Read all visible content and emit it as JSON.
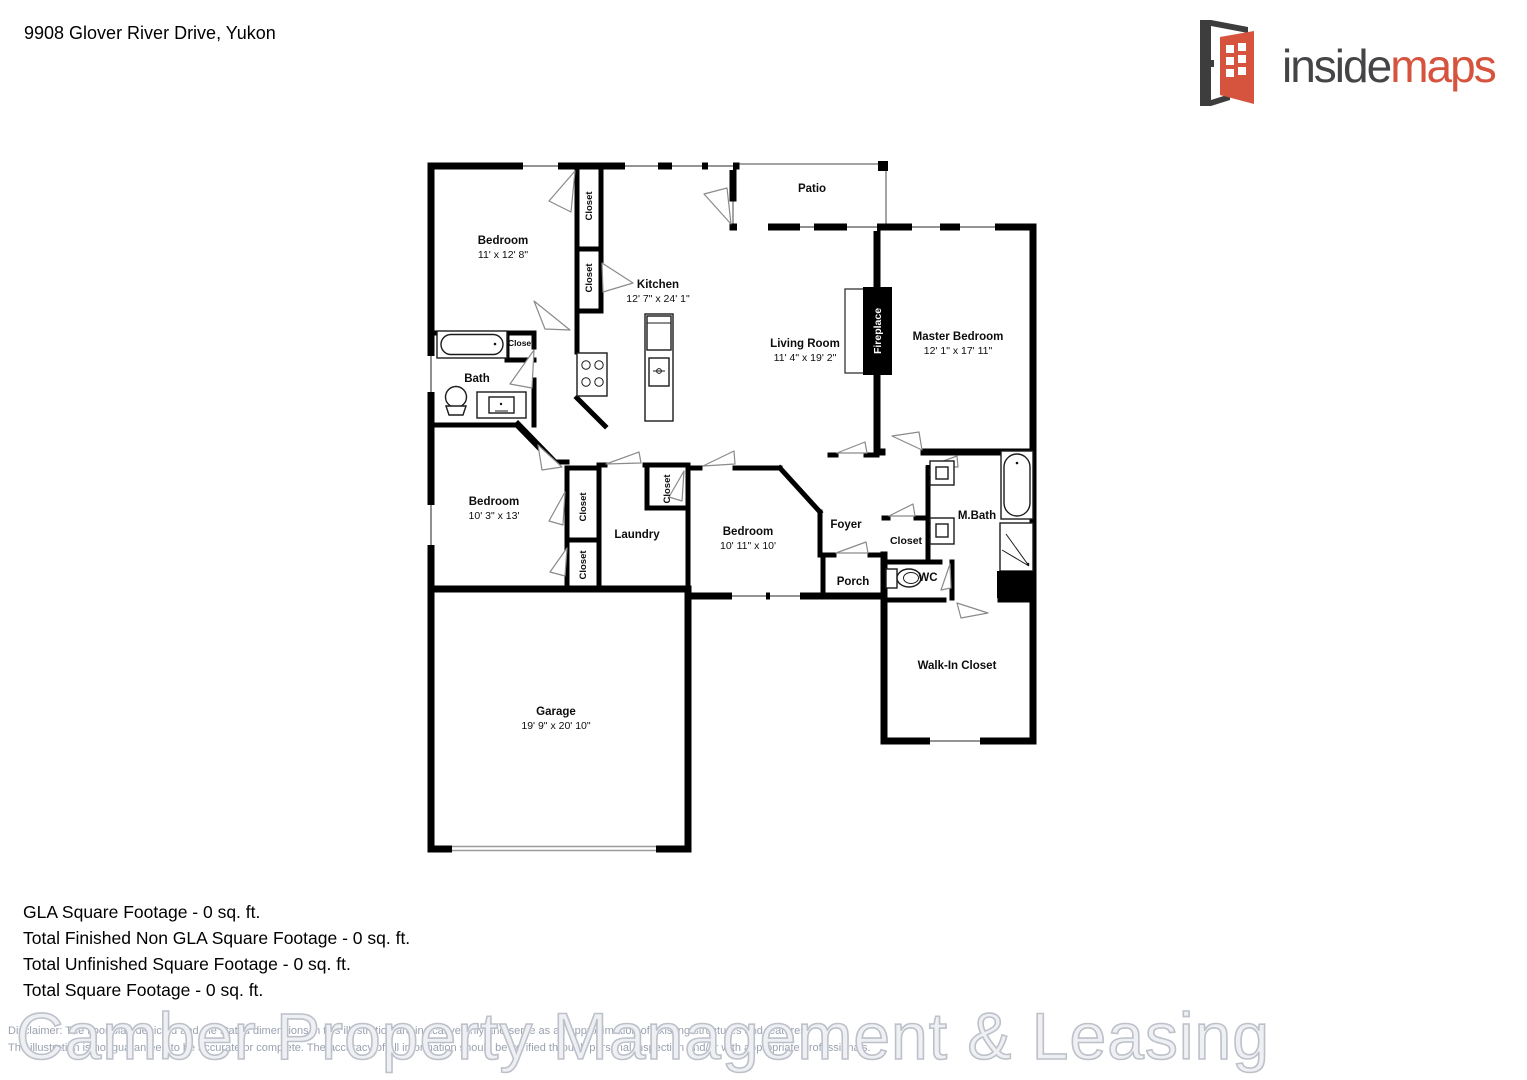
{
  "page": {
    "address": "9908 Glover River Drive, Yukon",
    "logo": {
      "inside": "inside",
      "maps": "maps",
      "accent_color": "#d6533e",
      "dark_color": "#454548"
    },
    "summary": [
      "GLA Square Footage - 0 sq. ft.",
      "Total Finished Non GLA Square Footage - 0 sq. ft.",
      "Total Unfinished Square Footage - 0 sq. ft.",
      "Total Square Footage - 0 sq. ft."
    ],
    "watermark": "Camber Property Management & Leasing",
    "disclaimer": {
      "line1": "Disclaimer: The floor plan depicted and the stated dimensions in this illustration are indicative only and serve as an approximation of existing structures and features.",
      "line2": "The illustration is not guaranteed to be accurate or complete. The accuracy of all information should be verified through personal inspection and/or with appropriate professionals."
    }
  },
  "floorplan": {
    "closet": "Closet",
    "bedroom1": {
      "name": "Bedroom",
      "dims": "11' x 12' 8\""
    },
    "kitchen": {
      "name": "Kitchen",
      "dims": "12' 7\" x 24' 1\""
    },
    "patio": "Patio",
    "living": {
      "name": "Living Room",
      "dims": "11' 4\" x 19' 2\""
    },
    "fireplace": "Fireplace",
    "master": {
      "name": "Master Bedroom",
      "dims": "12' 1\" x 17' 11\""
    },
    "bath": "Bath",
    "bedroom2": {
      "name": "Bedroom",
      "dims": "10' 3\" x 13'"
    },
    "laundry": "Laundry",
    "bedroom3": {
      "name": "Bedroom",
      "dims": "10' 11\" x 10'"
    },
    "foyer": "Foyer",
    "mbath": "M.Bath",
    "wc": "WC",
    "porch": "Porch",
    "walkin": "Walk-In Closet",
    "garage": {
      "name": "Garage",
      "dims": "19' 9\" x 20' 10\""
    }
  }
}
